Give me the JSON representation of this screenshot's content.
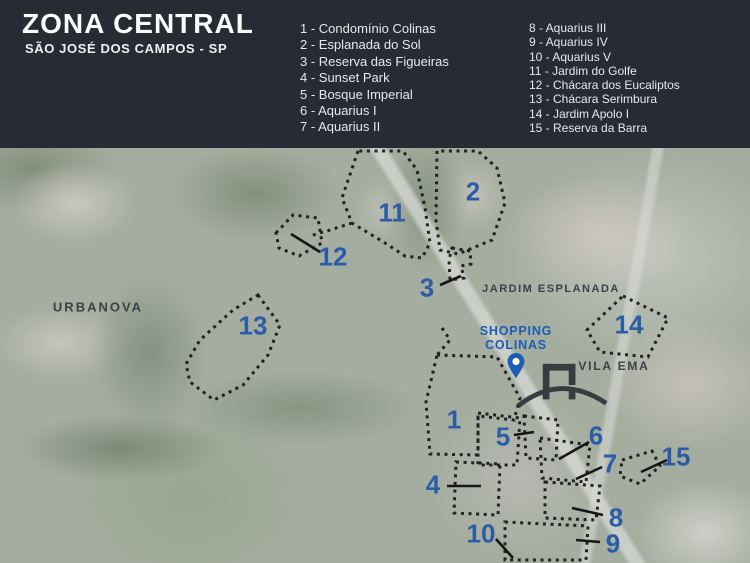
{
  "header": {
    "title": "ZONA CENTRAL",
    "subtitle": "SÃO JOSÉ DOS CAMPOS - SP",
    "legend_col1": [
      "1 - Condomínio Colinas",
      "2 - Esplanada do Sol",
      "3 - Reserva das Figueiras",
      "4 - Sunset Park",
      "5 - Bosque Imperial",
      "6 - Aquarius I",
      "7 - Aquarius II"
    ],
    "legend_col2": [
      "8 - Aquarius III",
      "9 - Aquarius IV",
      "10 - Aquarius V",
      "11 - Jardim do Golfe",
      "12 - Chácara dos Eucaliptos",
      "13 - Chácara Serimbura",
      "14 - Jardim Apolo I",
      "15 - Reserva da Barra"
    ]
  },
  "map": {
    "markers": [
      "1",
      "2",
      "3",
      "4",
      "5",
      "6",
      "7",
      "8",
      "9",
      "10",
      "11",
      "12",
      "13",
      "14",
      "15"
    ],
    "area_labels": {
      "urbanova": "URBANOVA",
      "jardim_esplanada": "JARDIM ESPLANADA",
      "vila_ema": "VILA EMA"
    },
    "poi": {
      "shopping_line1": "SHOPPING",
      "shopping_line2": "COLINAS",
      "pin_icon": "map-pin",
      "logo_icon": "arch-monument-logo"
    },
    "colors": {
      "header_bg": "#262b34",
      "marker_blue": "#2b5da6",
      "shopping_blue": "#1a5fb4",
      "outline_black": "#161616",
      "area_label_gray": "#3b4147"
    }
  }
}
